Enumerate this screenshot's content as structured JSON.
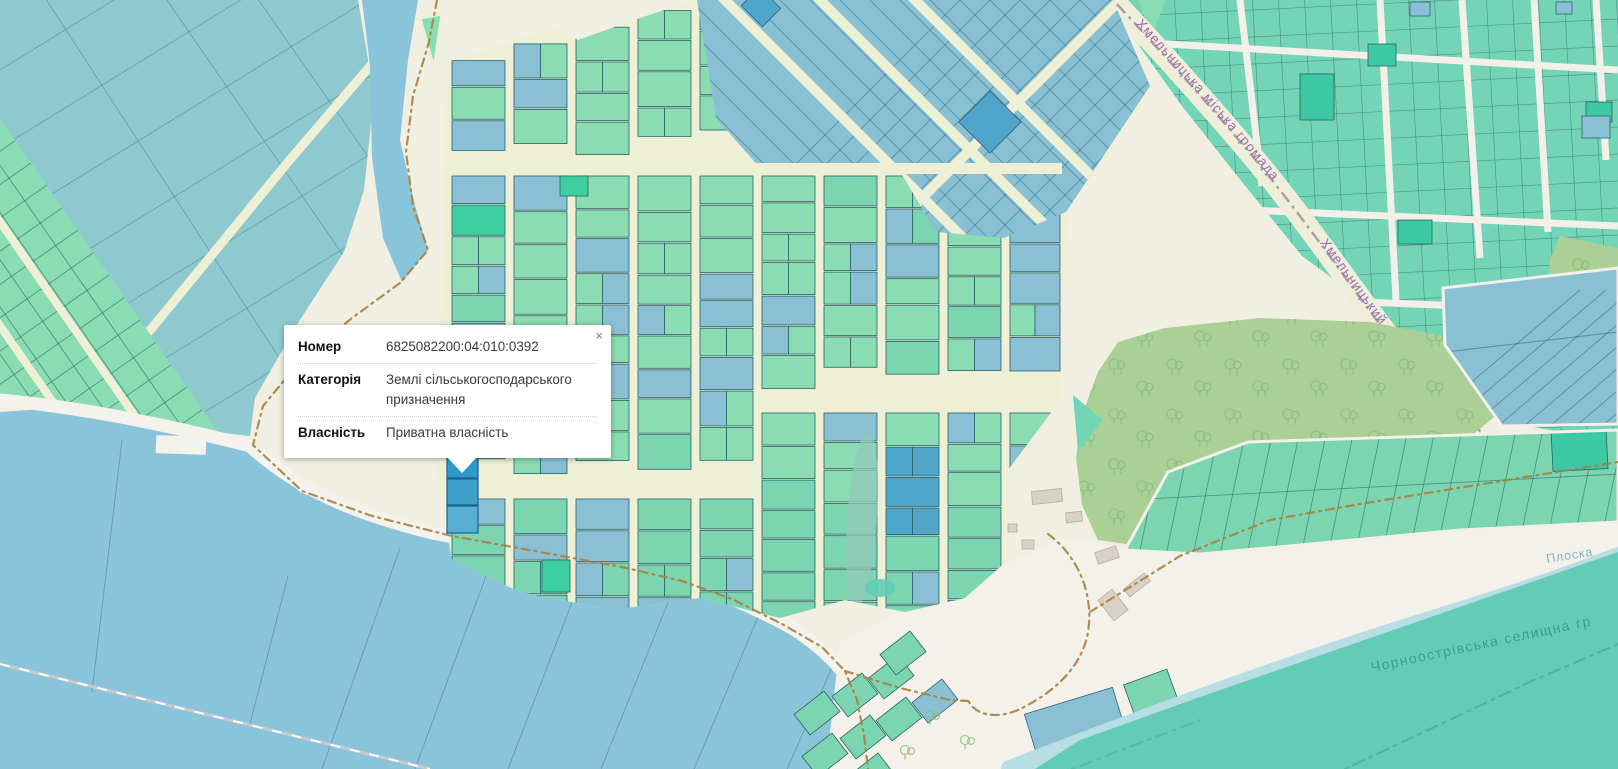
{
  "popup": {
    "close": "×",
    "rows": [
      {
        "label": "Номер",
        "value": "6825082200:04:010:0392"
      },
      {
        "label": "Категорія",
        "value": "Землі сільськогосподарського призначення"
      },
      {
        "label": "Власність",
        "value": "Приватна власність"
      }
    ]
  },
  "map": {
    "labels": {
      "city_hromada_boundary": "Хмельницька міська громада",
      "road": "Хмельницький",
      "river": "Плоска",
      "settlement_boundary": "Чорноострівська селищна гр"
    },
    "colors": {
      "farmland": "#8dc9cf",
      "mint": "#8adcb2",
      "garden_teal": "#7bd5b0",
      "blue": "#89c0d3",
      "blue_dark": "#4fa5c9",
      "bright_green": "#3ecfa0",
      "village": "#74d4b6",
      "village_dark": "#3cc9a4",
      "water": "#8ac4da",
      "river": "#b7dde5",
      "forest": "#abd096",
      "tree": "#8fbc7c",
      "hromada": "#63ccb6",
      "road": "#eef0d6",
      "shore": "#f4f2ec",
      "beach": "#f3f1ea",
      "outline": "#2b6168",
      "outline_blue": "#35607a",
      "selected": "#2d9bca",
      "selected_border": "#19618f",
      "boundary_brown": "#a8813f",
      "boundary_gray": "#9e8a93",
      "boundary_teal": "#48b19b",
      "building": "#d8d2c6",
      "building_border": "#b7ad9e",
      "railway": "#c9c9c9"
    }
  }
}
